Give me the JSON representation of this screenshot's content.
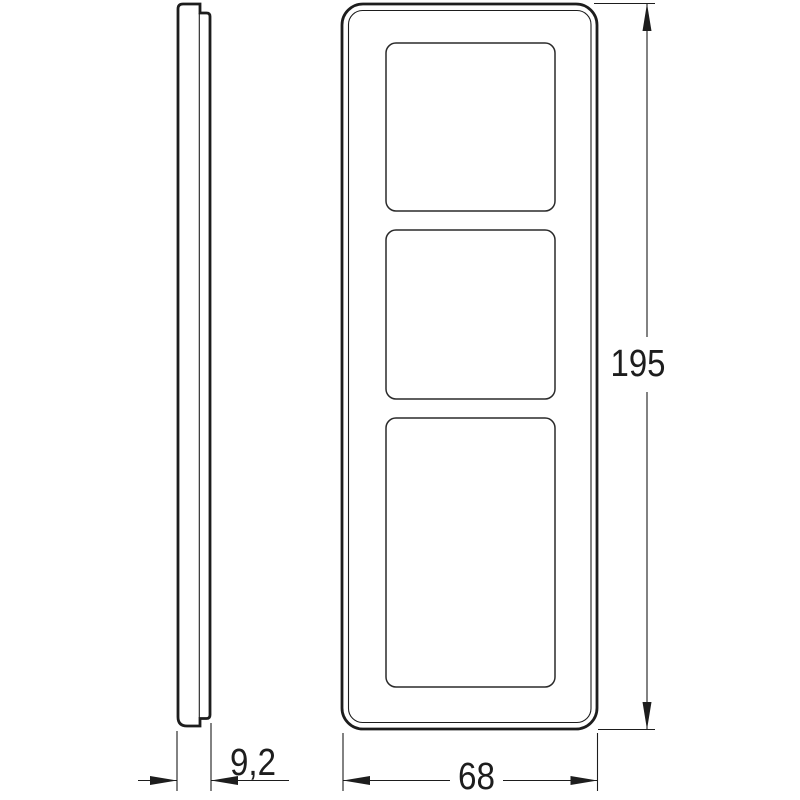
{
  "drawing": {
    "background_color": "#ffffff",
    "line_color": "#1d1d1d",
    "views": {
      "side_view": {
        "name": "side profile view"
      },
      "front_view": {
        "name": "front view",
        "window_count": 3
      }
    },
    "dimensions": {
      "height": {
        "label": "195"
      },
      "width": {
        "label": "68"
      },
      "depth": {
        "label": "9,2"
      }
    }
  }
}
